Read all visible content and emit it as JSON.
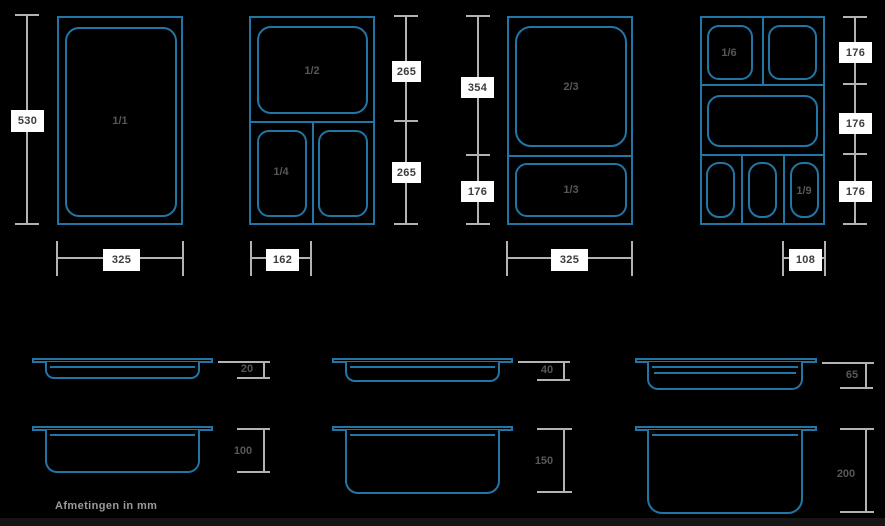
{
  "colors": {
    "background": "#000000",
    "pan_outline_blue": "#2176a6",
    "dimension_line_gray": "#b3b3b3",
    "dimension_box_bg": "#ffffff",
    "dimension_box_text": "#3c3c3c",
    "pan_label_gray": "#54575a",
    "depth_label_gray": "#575757",
    "caption_gray": "#9b9b9b",
    "footer_bar": "#161616"
  },
  "caption": "Afmetingen in mm",
  "top_views": {
    "gn11": {
      "pan": "1/1",
      "height": "530",
      "width": "325"
    },
    "gn12": {
      "pan_top": "1/2",
      "pan_bottom_left": "1/4",
      "height_top": "265",
      "height_bottom": "265",
      "width": "162"
    },
    "gn23": {
      "pan_top": "2/3",
      "pan_bottom": "1/3",
      "height_top": "354",
      "height_bottom": "176",
      "width": "325"
    },
    "gn16": {
      "pan_top_left": "1/6",
      "pan_bottom_right": "1/9",
      "height_row1": "176",
      "height_row2": "176",
      "height_row3": "176",
      "width": "108"
    }
  },
  "side_views": {
    "depth_20": "20",
    "depth_40": "40",
    "depth_65": "65",
    "depth_100": "100",
    "depth_150": "150",
    "depth_200": "200"
  }
}
